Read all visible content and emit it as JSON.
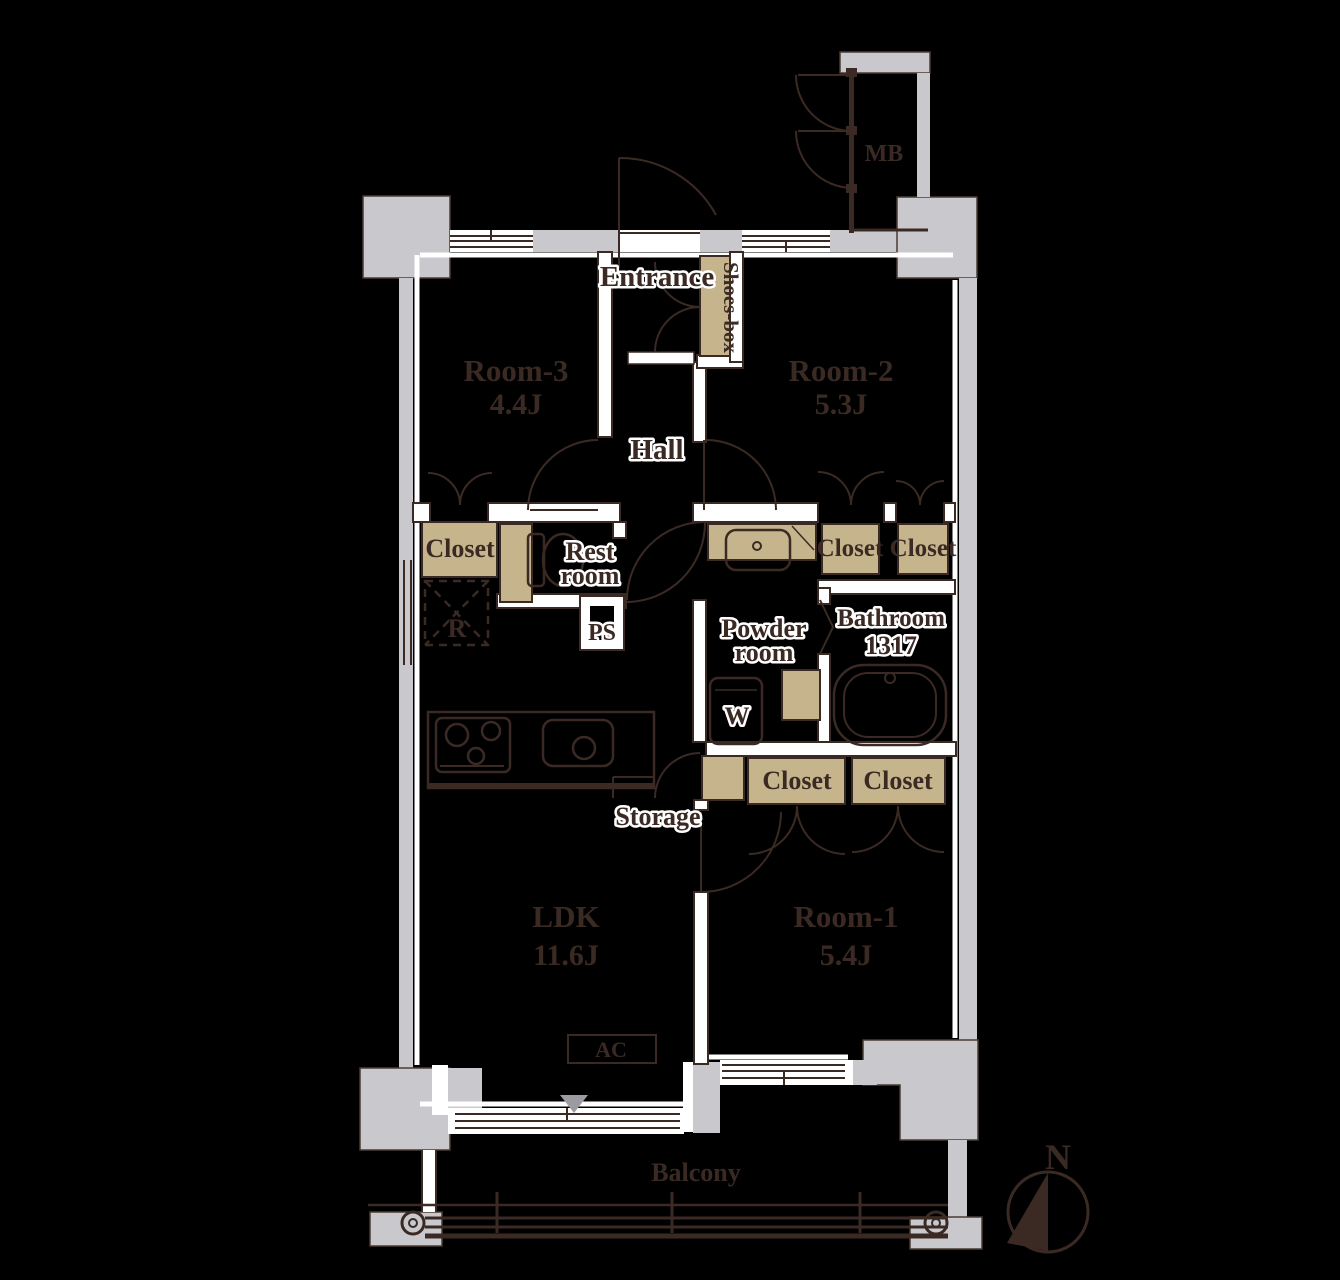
{
  "title": "Apartment floor plan 3LDK",
  "palette": {
    "background": "#000000",
    "wall_gray": "#c9c9cd",
    "line_dark": "#3b2a24",
    "joinery_tan": "#c6b58c",
    "label_halo": "#ffffff",
    "triangle_gray": "#9b9ba1"
  },
  "rooms": {
    "room3": {
      "name": "Room-3",
      "size": "4.4J"
    },
    "room2": {
      "name": "Room-2",
      "size": "5.3J"
    },
    "room1": {
      "name": "Room-1",
      "size": "5.4J"
    },
    "ldk": {
      "name": "LDK",
      "size": "11.6J"
    },
    "bathroom": {
      "name": "Bathroom",
      "size": "1317"
    },
    "powder_room": {
      "line1": "Powder",
      "line2": "room"
    },
    "rest_room": {
      "line1": "Rest",
      "line2": "room"
    }
  },
  "labels": {
    "entrance": "Entrance",
    "shoes_box": "Shoes-box",
    "hall": "Hall",
    "closet": "Closet",
    "storage": "Storage",
    "balcony": "Balcony",
    "meter_box": "MB",
    "air_conditioner": "AC",
    "pipe_space": "PS",
    "refrigerator": "R",
    "washer": "W",
    "north": "N"
  }
}
